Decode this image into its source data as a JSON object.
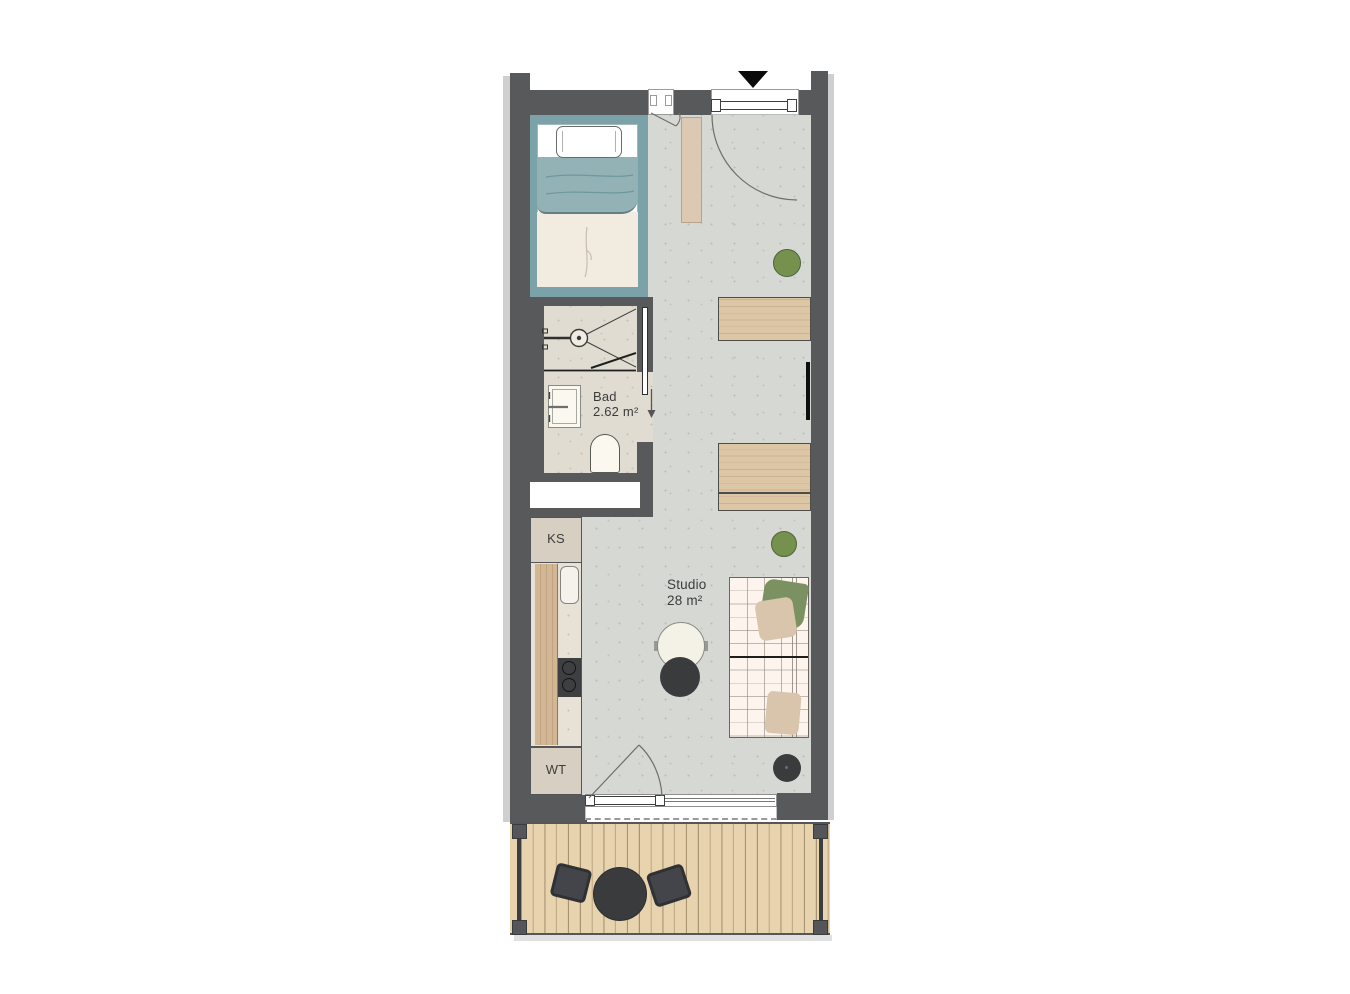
{
  "plan": {
    "labels": {
      "bathroom_name": "Bad",
      "bathroom_area": "2.62 m²",
      "studio_name": "Studio",
      "studio_area": "28 m²",
      "fridge": "KS",
      "washer": "WT"
    },
    "rooms": [
      {
        "name": "Bad",
        "area": "2.62 m²"
      },
      {
        "name": "Studio",
        "area": "28 m²"
      }
    ],
    "colors": {
      "wall": "#58595b",
      "floor": "#d6d8d4",
      "bathroom_floor": "#e1dcd2",
      "bed_frame_teal": "#7ba2a8",
      "blanket_teal": "#93b2b6",
      "wood": "#dcc6a6",
      "deck_wood": "#e5d1ad",
      "stool_green": "#76904d",
      "furniture_dark": "#3a3b3d",
      "daybed_cream": "#fdf4ee"
    }
  }
}
